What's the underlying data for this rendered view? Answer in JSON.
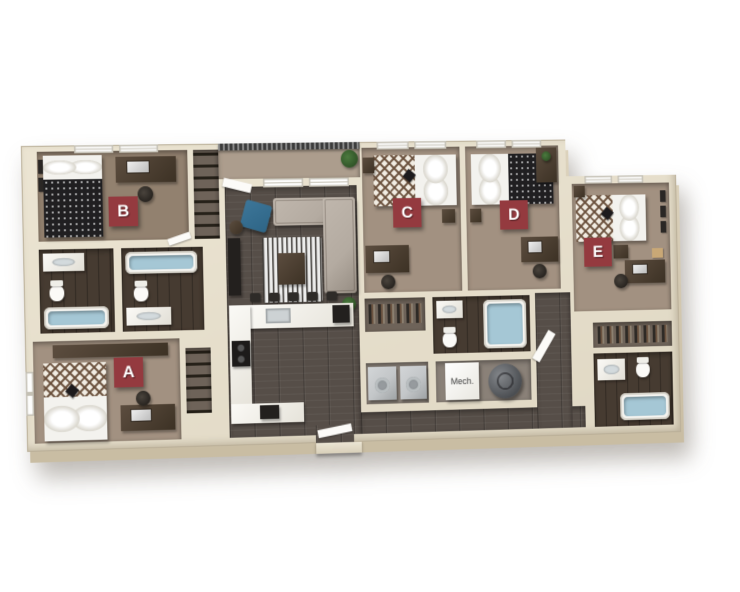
{
  "floorplan": {
    "unit_labels": {
      "a": "A",
      "b": "B",
      "c": "C",
      "d": "D",
      "e": "E"
    },
    "mech_room_label": "Mech.",
    "colors": {
      "background": "#ffffff",
      "label_bg": "#943a3f",
      "label_text": "#ffffff",
      "wall_top": "#ece5d3",
      "wall_face": "#d5cab2",
      "carpet": "#a29181",
      "carpet_dark": "#92816f",
      "wood": "#564e48",
      "tile": "#463b31",
      "water": "#a5c7d5",
      "sofa": "#b4aba1",
      "accent_chair": "#2e6586",
      "appliance": "#c3c6c8",
      "furniture_dark": "#54463a",
      "plant": "#4c7a3f"
    }
  }
}
